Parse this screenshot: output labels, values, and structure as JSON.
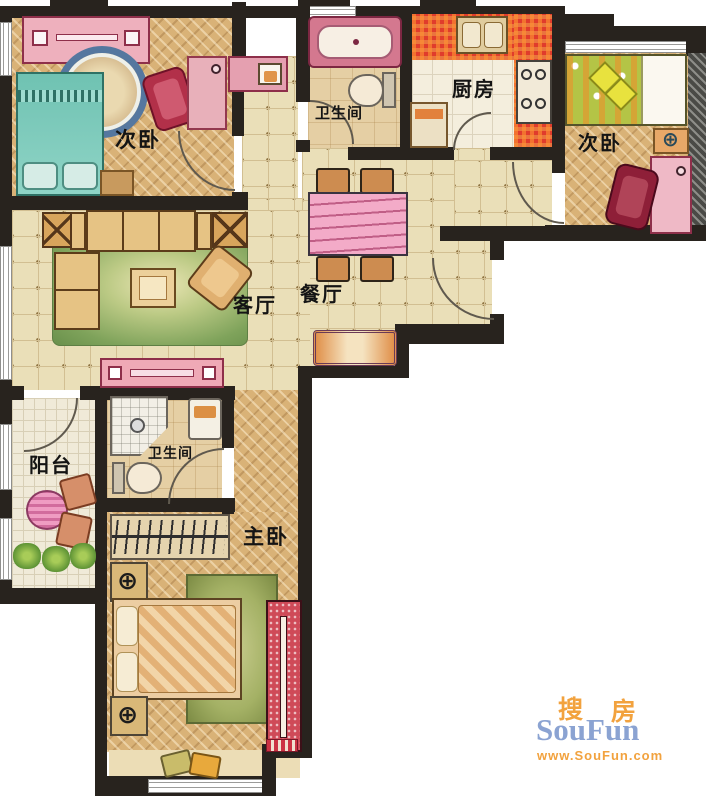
{
  "floorplan": {
    "rooms": {
      "bedroom_left": {
        "label": "次卧"
      },
      "bathroom_top": {
        "label": "卫生间"
      },
      "kitchen": {
        "label": "厨房"
      },
      "bedroom_right": {
        "label": "次卧"
      },
      "living_room": {
        "label": "客厅"
      },
      "dining_room": {
        "label": "餐厅"
      },
      "balcony": {
        "label": "阳台"
      },
      "bathroom_master": {
        "label": "卫生间"
      },
      "master_bedroom": {
        "label": "主卧"
      }
    },
    "icons": {
      "lamp_symbol": "⊕"
    },
    "colors": {
      "wall": "#28231e",
      "parquet": "#d9b277",
      "tile": "#eadfb8",
      "mosaic_red": "#e03c2c",
      "bed_teal": "#74c4b4",
      "rug_green": "#8fae62",
      "accent_pink": "#efaec2"
    }
  },
  "watermark": {
    "brand_cjk_first": "搜",
    "brand_cjk_second": "房",
    "brand_latin": "SouFun",
    "url": "www.SouFun.com",
    "blue": "#8ba3d2",
    "orange": "#f2a23e"
  }
}
